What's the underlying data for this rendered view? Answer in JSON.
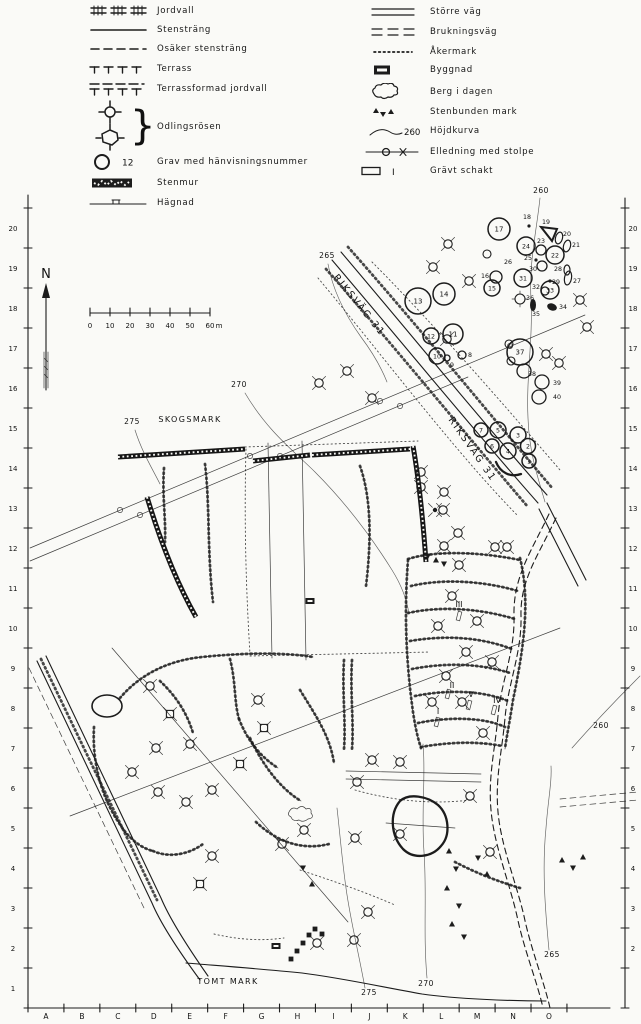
{
  "colors": {
    "ink": "#1c1c1c",
    "paper": "#fafaf7"
  },
  "legend": {
    "left": [
      {
        "id": "jordvall",
        "label": "Jordvall"
      },
      {
        "id": "stenstrang",
        "label": "Stensträng"
      },
      {
        "id": "osaker-stenstrang",
        "label": "Osäker stensträng"
      },
      {
        "id": "terrass",
        "label": "Terrass"
      },
      {
        "id": "terrassformad-jordvall",
        "label": "Terrassformad jordvall"
      },
      {
        "id": "odlingsrosen",
        "label": "Odlingsrösen"
      },
      {
        "id": "grav",
        "label": "Grav med hänvisningsnummer",
        "sample_number": "12"
      },
      {
        "id": "stenmur",
        "label": "Stenmur"
      },
      {
        "id": "hagnad",
        "label": "Hägnad"
      }
    ],
    "right": [
      {
        "id": "storre-vag",
        "label": "Större väg"
      },
      {
        "id": "brukningsvag",
        "label": "Brukningsväg"
      },
      {
        "id": "akermark",
        "label": "Åkermark"
      },
      {
        "id": "byggnad",
        "label": "Byggnad"
      },
      {
        "id": "berg-i-dagen",
        "label": "Berg i dagen"
      },
      {
        "id": "stenbunden-mark",
        "label": "Stenbunden mark"
      },
      {
        "id": "hojdkurva",
        "label": "Höjdkurva",
        "sample_number": "260"
      },
      {
        "id": "elledning",
        "label": "Elledning med stolpe"
      },
      {
        "id": "gravt-schakt",
        "label": "Grävt schakt",
        "sample_number": "I"
      }
    ]
  },
  "north_label": "N",
  "scale_bar": {
    "ticks": [
      "0",
      "10",
      "20",
      "30",
      "40",
      "50",
      "60"
    ],
    "unit": "m"
  },
  "grid": {
    "letters": [
      "A",
      "B",
      "C",
      "D",
      "E",
      "F",
      "G",
      "H",
      "I",
      "J",
      "K",
      "L",
      "M",
      "N",
      "O"
    ],
    "left_numbers": [
      "20",
      "19",
      "18",
      "17",
      "16",
      "15",
      "14",
      "13",
      "12",
      "11",
      "10",
      "9",
      "8",
      "7",
      "6",
      "5",
      "4",
      "3",
      "2",
      "1"
    ],
    "right_numbers": [
      "20",
      "19",
      "18",
      "17",
      "16",
      "15",
      "14",
      "13",
      "12",
      "11",
      "10",
      "9",
      "8",
      "7",
      "6",
      "5",
      "4",
      "3",
      "2"
    ]
  },
  "map_labels": [
    {
      "text": "SKOGSMARK",
      "x": 190,
      "y": 422,
      "rot": 0,
      "size": 8,
      "ls": 1.4
    },
    {
      "text": "TOMT MARK",
      "x": 228,
      "y": 984,
      "rot": 0,
      "size": 8,
      "ls": 1.4
    },
    {
      "text": "RIKSVÄG 31",
      "x": 357,
      "y": 307,
      "rot": 51,
      "size": 9.5,
      "ls": 2
    },
    {
      "text": "RIKSVÄG 31",
      "x": 470,
      "y": 451,
      "rot": 55,
      "size": 9.5,
      "ls": 2
    },
    {
      "text": "265",
      "x": 327,
      "y": 258,
      "rot": 0,
      "size": 7.5,
      "ls": 0.5
    },
    {
      "text": "260",
      "x": 541,
      "y": 193,
      "rot": 0,
      "size": 7.5,
      "ls": 0.5
    },
    {
      "text": "270",
      "x": 239,
      "y": 387,
      "rot": 0,
      "size": 7.5,
      "ls": 0.5
    },
    {
      "text": "275",
      "x": 132,
      "y": 424,
      "rot": 0,
      "size": 7.5,
      "ls": 0.5
    },
    {
      "text": "275",
      "x": 369,
      "y": 995,
      "rot": 0,
      "size": 7.5,
      "ls": 0.5
    },
    {
      "text": "270",
      "x": 426,
      "y": 986,
      "rot": 0,
      "size": 7.5,
      "ls": 0.5
    },
    {
      "text": "265",
      "x": 552,
      "y": 957,
      "rot": 0,
      "size": 7.5,
      "ls": 0.5
    },
    {
      "text": "260",
      "x": 601,
      "y": 728,
      "rot": 0,
      "size": 7.5,
      "ls": 0.5
    },
    {
      "text": "III",
      "x": 459,
      "y": 607,
      "rot": 0,
      "size": 8,
      "ls": 0
    },
    {
      "text": "II",
      "x": 452,
      "y": 688,
      "rot": 0,
      "size": 8,
      "ls": 0
    },
    {
      "text": "V",
      "x": 471,
      "y": 697,
      "rot": 0,
      "size": 8,
      "ls": 0
    },
    {
      "text": "IV",
      "x": 497,
      "y": 703,
      "rot": 0,
      "size": 8,
      "ls": 0
    },
    {
      "text": "I",
      "x": 438,
      "y": 714,
      "rot": 0,
      "size": 8,
      "ls": 0
    }
  ],
  "graves_numbered_circles": [
    {
      "n": "1",
      "x": 529,
      "y": 461,
      "r": 7
    },
    {
      "n": "2",
      "x": 528,
      "y": 446,
      "r": 7.5
    },
    {
      "n": "3",
      "x": 518,
      "y": 435,
      "r": 8
    },
    {
      "n": "4",
      "x": 508,
      "y": 451,
      "r": 8
    },
    {
      "n": "5",
      "x": 498,
      "y": 430,
      "r": 8
    },
    {
      "n": "6",
      "x": 492,
      "y": 446,
      "r": 7
    },
    {
      "n": "7",
      "x": 481,
      "y": 430,
      "r": 7
    },
    {
      "n": "10",
      "x": 437,
      "y": 356,
      "r": 8
    },
    {
      "n": "11",
      "x": 453,
      "y": 334,
      "r": 10
    },
    {
      "n": "12",
      "x": 431,
      "y": 336,
      "r": 8
    },
    {
      "n": "13",
      "x": 418,
      "y": 301,
      "r": 13
    },
    {
      "n": "14",
      "x": 444,
      "y": 294,
      "r": 11
    },
    {
      "n": "15",
      "x": 492,
      "y": 288,
      "r": 8
    },
    {
      "n": "17",
      "x": 499,
      "y": 229,
      "r": 11
    },
    {
      "n": "22",
      "x": 555,
      "y": 255,
      "r": 9
    },
    {
      "n": "24",
      "x": 526,
      "y": 246,
      "r": 9
    },
    {
      "n": "31",
      "x": 523,
      "y": 278,
      "r": 9
    },
    {
      "n": "33",
      "x": 550,
      "y": 290,
      "r": 9
    },
    {
      "n": "37",
      "x": 520,
      "y": 352,
      "r": 13
    }
  ],
  "graves_labelled": [
    {
      "n": "8",
      "x": 470,
      "y": 355,
      "sym": "circle",
      "sx": 462,
      "sy": 355,
      "r": 4
    },
    {
      "n": "9",
      "x": 452,
      "y": 365,
      "sym": "circle",
      "sx": 447,
      "sy": 358,
      "r": 3
    },
    {
      "n": "16",
      "x": 485,
      "y": 276,
      "sym": "circle",
      "sx": 496,
      "sy": 277,
      "r": 6
    },
    {
      "n": "18",
      "x": 527,
      "y": 217,
      "sym": "dot",
      "sx": 529,
      "sy": 226,
      "r": 1.6
    },
    {
      "n": "19",
      "x": 546,
      "y": 222,
      "sym": "triangle",
      "sx": 549,
      "sy": 233,
      "r": 8
    },
    {
      "n": "20",
      "x": 567,
      "y": 234,
      "sym": "ellipse",
      "sx": 559,
      "sy": 238,
      "rx": 3.5,
      "ry": 6,
      "rot": 15
    },
    {
      "n": "21",
      "x": 576,
      "y": 245,
      "sym": "ellipse",
      "sx": 567,
      "sy": 246,
      "rx": 3.5,
      "ry": 6,
      "rot": 15
    },
    {
      "n": "23",
      "x": 541,
      "y": 241,
      "sym": "circle",
      "sx": 541,
      "sy": 250,
      "r": 5
    },
    {
      "n": "25",
      "x": 528,
      "y": 258,
      "sym": "dot",
      "sx": 536,
      "sy": 260,
      "r": 1.6
    },
    {
      "n": "26",
      "x": 508,
      "y": 262,
      "sym": "none"
    },
    {
      "n": "27",
      "x": 577,
      "y": 281,
      "sym": "ellipse",
      "sx": 568,
      "sy": 278,
      "rx": 3.5,
      "ry": 7,
      "rot": 10
    },
    {
      "n": "28",
      "x": 558,
      "y": 269,
      "sym": "ellipse",
      "sx": 567,
      "sy": 270,
      "rx": 3,
      "ry": 5,
      "rot": 0
    },
    {
      "n": "29",
      "x": 556,
      "y": 282,
      "sym": "dot",
      "sx": 550,
      "sy": 281,
      "r": 1.6
    },
    {
      "n": "30",
      "x": 533,
      "y": 269,
      "sym": "circle",
      "sx": 542,
      "sy": 266,
      "r": 5
    },
    {
      "n": "32",
      "x": 536,
      "y": 287,
      "sym": "circle",
      "sx": 545,
      "sy": 291,
      "r": 4
    },
    {
      "n": "34",
      "x": 563,
      "y": 307,
      "sym": "blob",
      "sx": 552,
      "sy": 307,
      "rx": 5,
      "ry": 3.5,
      "rot": 20
    },
    {
      "n": "35",
      "x": 536,
      "y": 314,
      "sym": "blob",
      "sx": 533,
      "sy": 305,
      "rx": 3,
      "ry": 6,
      "rot": 0
    },
    {
      "n": "36",
      "x": 530,
      "y": 298,
      "sym": "rose",
      "sx": 520,
      "sy": 299,
      "r": 5
    },
    {
      "n": "38",
      "x": 532,
      "y": 374,
      "sym": "circle",
      "sx": 524,
      "sy": 371,
      "r": 7
    },
    {
      "n": "39",
      "x": 557,
      "y": 383,
      "sym": "circle",
      "sx": 542,
      "sy": 382,
      "r": 7
    },
    {
      "n": "40",
      "x": 557,
      "y": 397,
      "sym": "circle",
      "sx": 539,
      "sy": 397,
      "r": 7
    }
  ]
}
